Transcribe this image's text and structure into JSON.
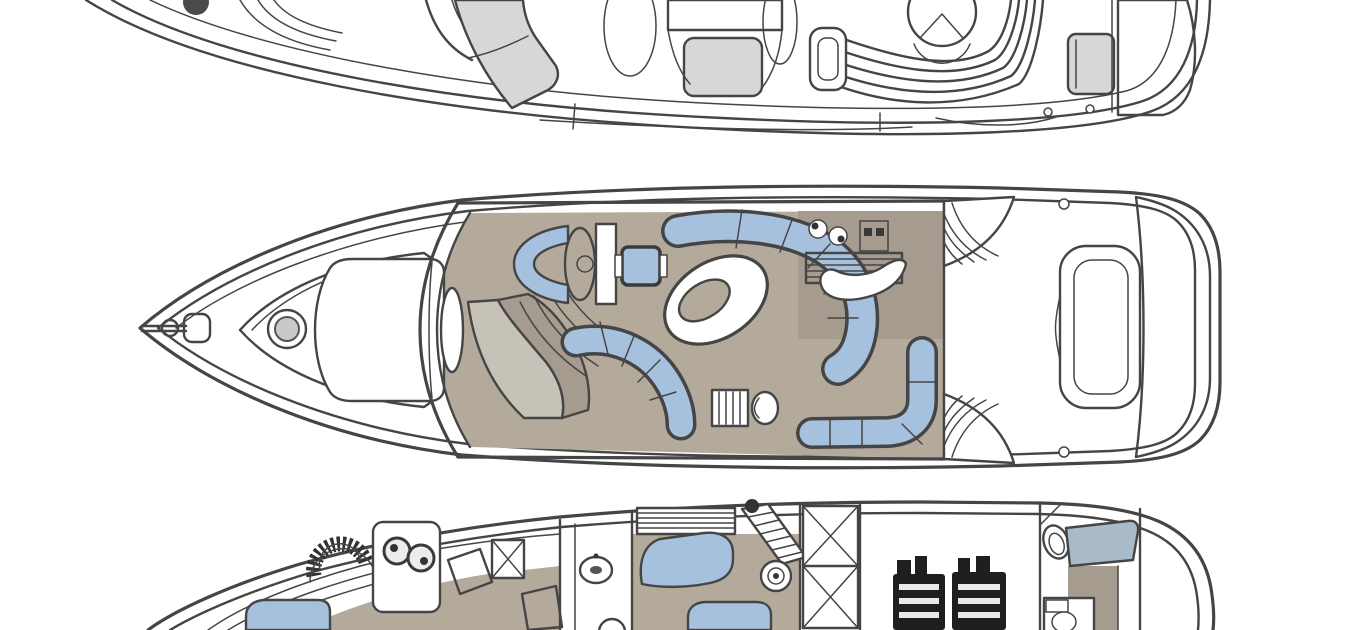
{
  "palette": {
    "background": "#ffffff",
    "line": "#454545",
    "seat_blue": "#a6c1de",
    "blue_gray": "#a9bac9",
    "floor_tan": "#b4aa9c",
    "floor_tan_dark": "#a59b8e",
    "gray_light": "#d7d7d7",
    "gray_mid": "#c7c2b8",
    "engine_dark": "#1f1f1f",
    "hatch_gray": "#9a9a9a"
  },
  "diagram": {
    "type": "yacht-deck-plans",
    "orientation": "bow-left",
    "decks": [
      {
        "name": "flybridge-deck",
        "cropped_edge": "top",
        "features": [
          "helm-area",
          "sun-lounger-seats",
          "louvered-vent",
          "console",
          "dinette-table",
          "curved-bench-seat",
          "stern-locker",
          "aft-sun-pad",
          "deck-fittings"
        ]
      },
      {
        "name": "main-deck",
        "cropped_edge": "none",
        "features": [
          "bow-pulpit",
          "anchor-windlass",
          "foredeck-hatch",
          "foredeck-sun-pad",
          "windscreen",
          "helm-seat",
          "helm-console",
          "companion-table",
          "companionway-stairs",
          "curved-settee",
          "cocktail-table",
          "port-settee",
          "wet-bar",
          "galley",
          "galley-sinks",
          "stove",
          "breakfast-bar",
          "aft-sofa",
          "cockpit",
          "cockpit-steps",
          "transom-seat",
          "swim-platform"
        ]
      },
      {
        "name": "lower-deck",
        "cropped_edge": "bottom",
        "features": [
          "forward-berth",
          "hull-frames",
          "vent-fan",
          "vanity-sinks",
          "hatched-cabinet",
          "wardrobe",
          "shower",
          "washbasin",
          "toilet",
          "louvered-hatch",
          "guest-sofa",
          "guest-berth",
          "staircase",
          "speaker",
          "hanging-lockers",
          "engine-room",
          "port-engine",
          "starboard-engine",
          "aft-toilet",
          "aft-berth-headboard",
          "aft-vanity"
        ]
      }
    ]
  }
}
